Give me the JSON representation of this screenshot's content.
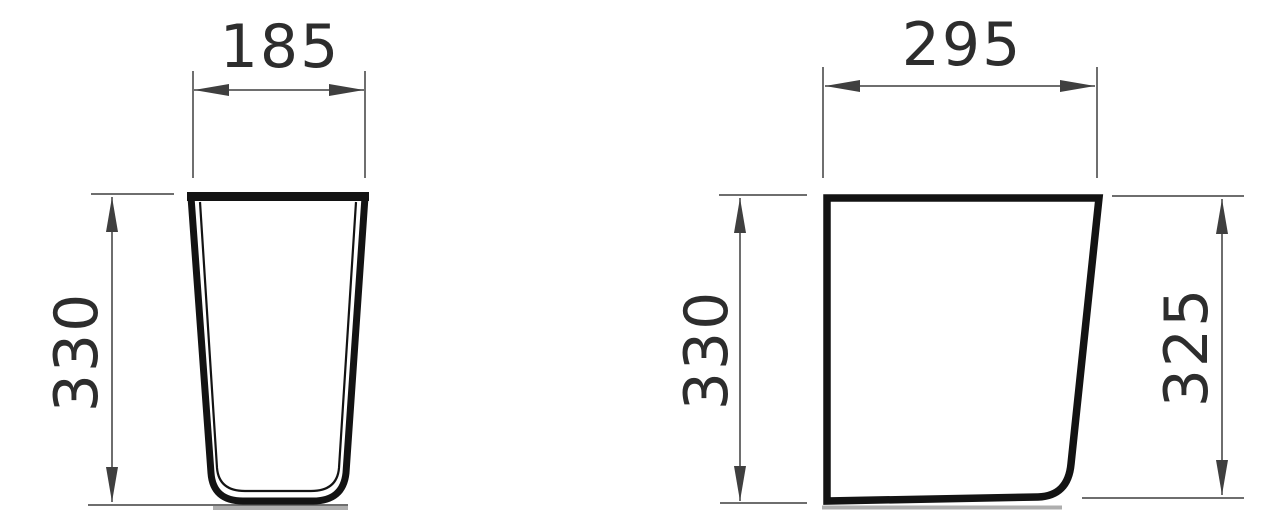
{
  "drawing": {
    "type": "technical-dimension-drawing",
    "views": {
      "front": {
        "width_mm": "185",
        "height_mm": "330"
      },
      "side": {
        "width_mm": "295",
        "height_front_mm": "330",
        "height_back_mm": "325"
      }
    }
  },
  "colors": {
    "bg": "#ffffff",
    "outline": "#131313",
    "thin": "#3f3f3f",
    "label": "#2d2d2d",
    "ground": "#9a9a9a"
  }
}
